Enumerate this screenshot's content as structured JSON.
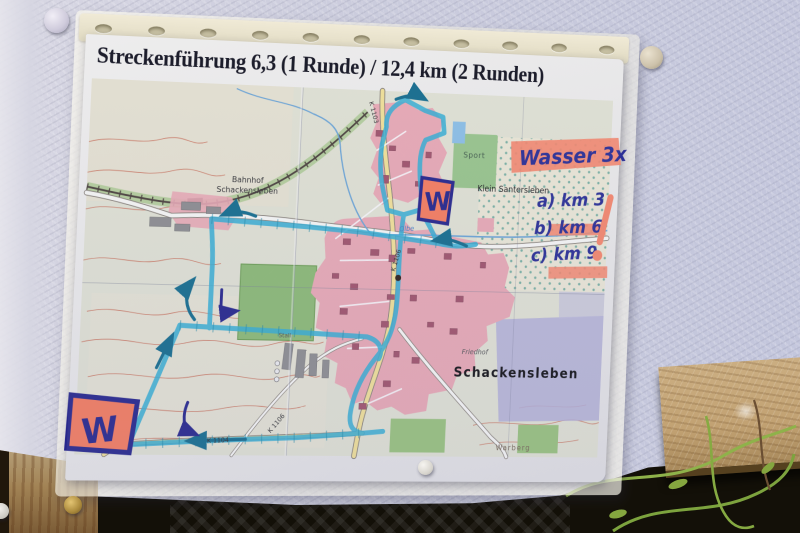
{
  "title": "Streckenführung 6,3 (1 Runde) / 12,4 km (2 Runden)",
  "annotations": {
    "wasser": "Wasser 3x",
    "items": [
      "a) km 3",
      "b) km 6",
      "c) km 9"
    ],
    "exclamation": "!",
    "water_mark_north": "W",
    "water_mark_southwest": "W"
  },
  "map_labels": {
    "bahnhof_line1": "Bahnhof",
    "bahnhof_line2": "Schackensleben",
    "sport": "Sport",
    "klein_santersleben": "Klein Santersleben",
    "schackensleben": "Schackensleben",
    "friedhof": "Friedhof",
    "warberg": "Warberg",
    "stall": "Stall",
    "olbe": "Olbe",
    "k1103": "K 1103",
    "k1104": "K 1104",
    "k1106": "K 1106",
    "k1106b": "K 1106"
  },
  "colors": {
    "route_highlight": "#35b2d6",
    "marker_blue": "#26268c",
    "highlighter_pink": "#fb8a6d",
    "village_pink": "#eeadb6",
    "wall": "#c9cbdc"
  }
}
